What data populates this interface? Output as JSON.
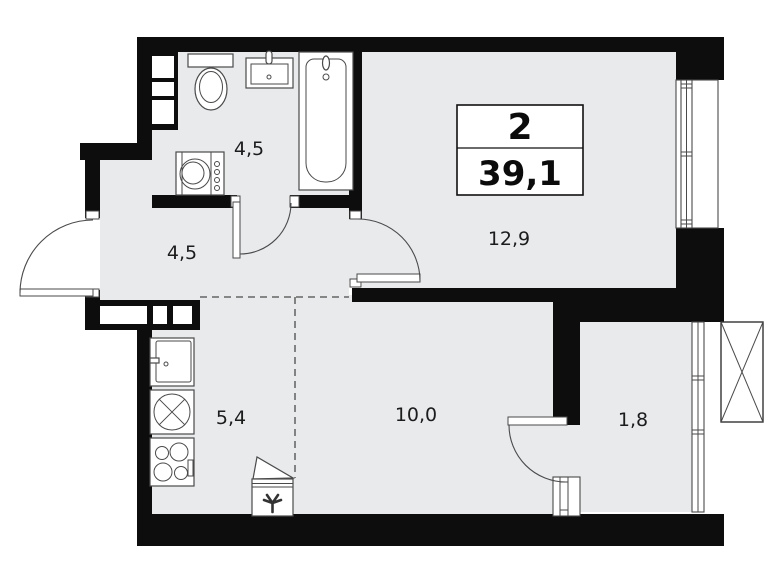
{
  "plan": {
    "type": "apartment-floor-plan",
    "title_box": {
      "rooms_count": "2",
      "total_area": "39,1"
    },
    "rooms": [
      {
        "name": "bathroom",
        "area": "4,5"
      },
      {
        "name": "hallway",
        "area": "4,5"
      },
      {
        "name": "living-room",
        "area": "12,9"
      },
      {
        "name": "kitchen",
        "area": "5,4"
      },
      {
        "name": "room",
        "area": "10,0"
      },
      {
        "name": "balcony",
        "area": "1,8"
      }
    ],
    "colors": {
      "wall": "#0d0d0d",
      "floor": "#e8eaec",
      "line": "#4a4a4a",
      "page": "#ffffff",
      "text": "#1c1c1c"
    }
  }
}
